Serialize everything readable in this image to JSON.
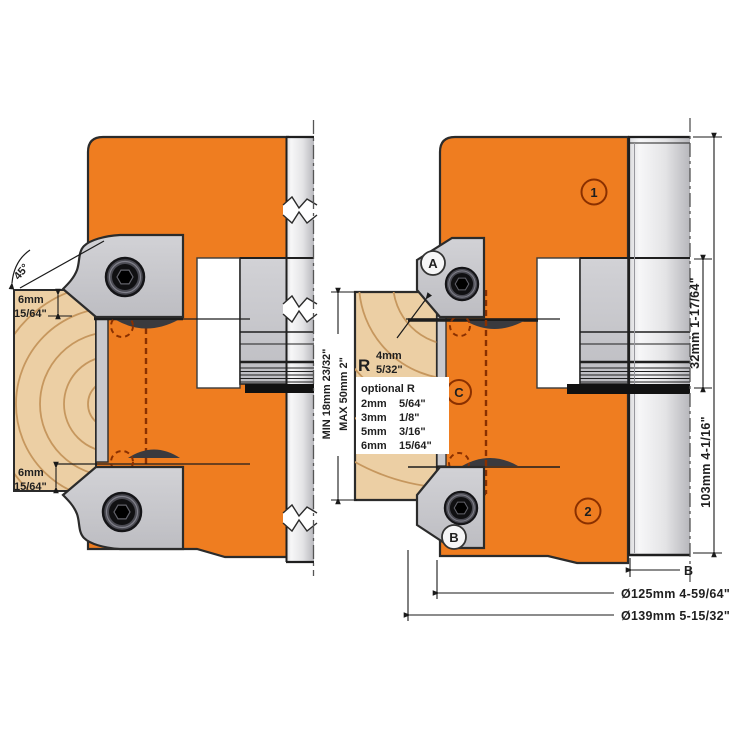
{
  "title": "Adjustable cutter head cross-section drawing",
  "colors": {
    "body_orange": "#EF7D20",
    "insert_gray": "#c9c9cd",
    "hub_light": "#f5f5f6",
    "hub_dark": "#bbbbc0",
    "wood": "#eccfa4",
    "wood_grain": "#c6975e",
    "knife_dark": "#3a3a3e",
    "outline": "#2b2b2b",
    "hidden_line_red": "#8a3000"
  },
  "labels": {
    "angle": "45°",
    "top_depth": {
      "mm": "6mm",
      "inch": "15/64\""
    },
    "bottom_depth": {
      "mm": "6mm",
      "inch": "15/64\""
    },
    "stock_min": "MIN  18mm  23/32\"",
    "stock_max": "MAX  50mm  2\"",
    "radius": {
      "r": "R",
      "mm": "4mm",
      "inch": "5/32\""
    },
    "optional_r": {
      "title": "optional R",
      "rows": [
        {
          "mm": "2mm",
          "inch": "5/64\""
        },
        {
          "mm": "3mm",
          "inch": "1/8\""
        },
        {
          "mm": "5mm",
          "inch": "3/16\""
        },
        {
          "mm": "6mm",
          "inch": "15/64\""
        }
      ]
    },
    "callouts": {
      "c1": "1",
      "c2": "2",
      "a": "A",
      "b": "B",
      "c": "C"
    },
    "dims": {
      "spacer_32": "32mm  1-17/64\"",
      "height_103": "103mm  4-1/16\"",
      "bore": "B",
      "dia_125": "Ø125mm  4-59/64\"",
      "dia_139": "Ø139mm  5-15/32\""
    }
  }
}
